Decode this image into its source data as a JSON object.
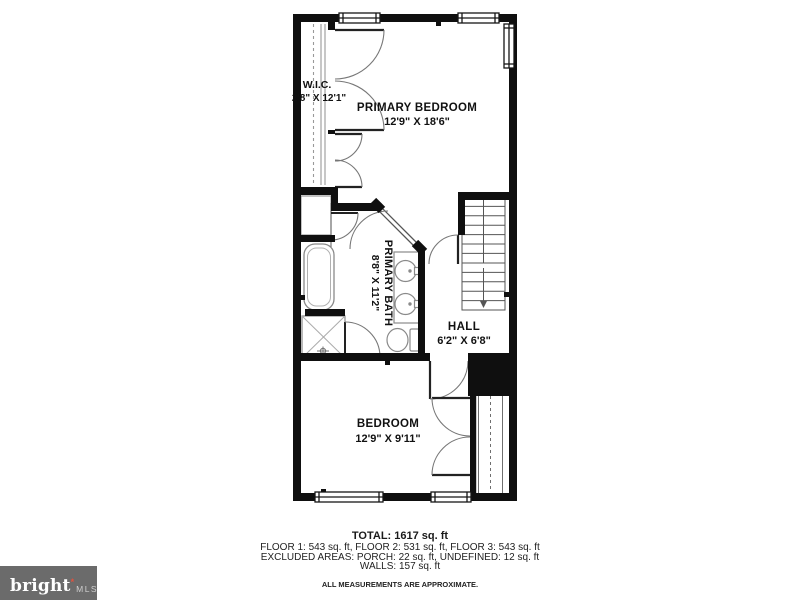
{
  "plan": {
    "rooms": [
      {
        "name": "PRIMARY BEDROOM",
        "dim": "12'9\" X 18'6\""
      },
      {
        "name": "W.I.C.",
        "dim": "2'8\" X 12'1\""
      },
      {
        "name": "PRIMARY BATH",
        "dim": "8'8\" X 11'2\""
      },
      {
        "name": "HALL",
        "dim": "6'2\" X 6'8\""
      },
      {
        "name": "BEDROOM",
        "dim": "12'9\" X 9'11\""
      }
    ],
    "fixtures": [
      "bathtub",
      "shower",
      "double-vanity-sinks",
      "toilet",
      "staircase-down",
      "walk-in-closet",
      "linen-closet",
      "bedroom-closet"
    ]
  },
  "summary": {
    "total": "TOTAL: 1617 sq. ft",
    "floor_breakdown": "FLOOR 1: 543 sq. ft, FLOOR 2: 531 sq. ft, FLOOR 3: 543 sq. ft",
    "excluded_areas": "EXCLUDED AREAS: PORCH: 22 sq. ft, UNDEFINED: 12 sq. ft",
    "walls": "WALLS: 157 sq. ft",
    "disclaimer": "ALL MEASUREMENTS ARE APPROXIMATE."
  },
  "logo": {
    "brand": "bright",
    "mark": "*",
    "suffix": "MLS"
  },
  "colors": {
    "wall": "#0f0f0f",
    "fixture_line": "#8a8a8a",
    "door_arc": "#777777",
    "text": "#111111",
    "logo_bg": "#6b6b6b",
    "logo_text": "#ffffff",
    "logo_mark": "#e0523f",
    "logo_suffix": "#cfcfcf"
  }
}
